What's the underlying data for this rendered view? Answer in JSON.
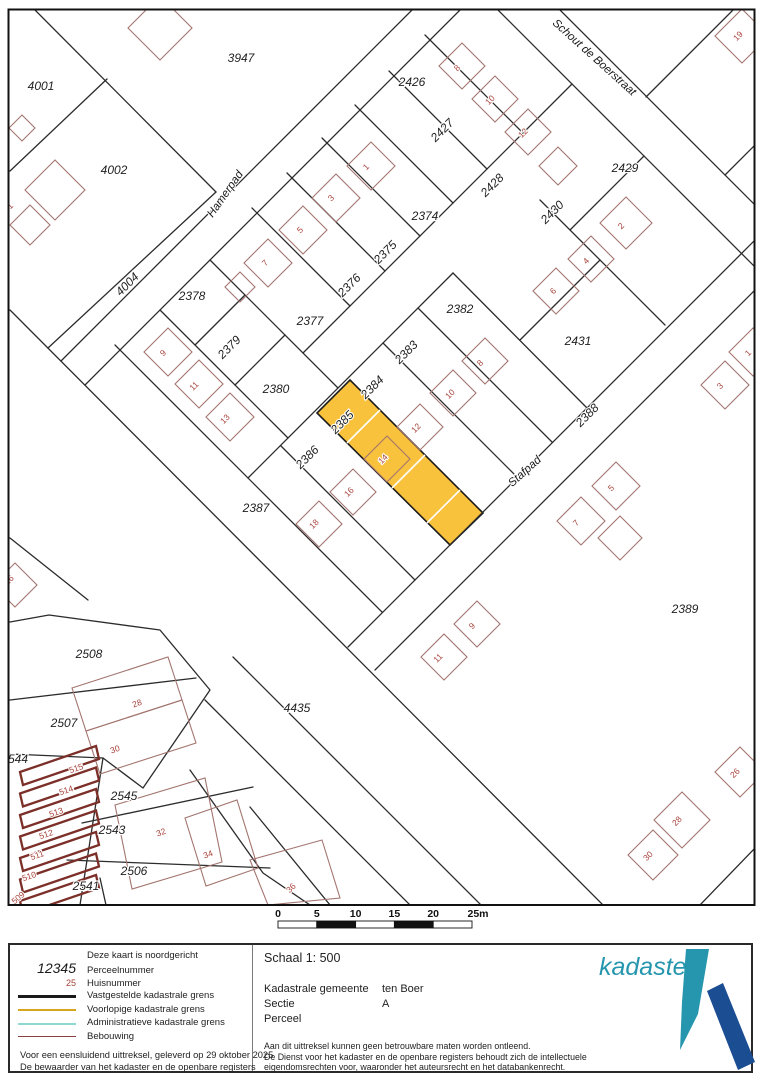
{
  "map": {
    "street_names": [
      {
        "t": "Hamerpad",
        "x": 228,
        "y": 196,
        "r": -55
      },
      {
        "t": "Schout de Boerstraat",
        "x": 592,
        "y": 60,
        "r": 42
      },
      {
        "t": "Stafpad",
        "x": 527,
        "y": 474,
        "r": -42
      }
    ],
    "parcel_labels": [
      {
        "t": "3947",
        "x": 241,
        "y": 62,
        "r": 0
      },
      {
        "t": "4001",
        "x": 41,
        "y": 90,
        "r": 0
      },
      {
        "t": "4002",
        "x": 114,
        "y": 174,
        "r": 0
      },
      {
        "t": "4004",
        "x": 130,
        "y": 287,
        "r": -45
      },
      {
        "t": "2426",
        "x": 412,
        "y": 86,
        "r": 0
      },
      {
        "t": "2427",
        "x": 445,
        "y": 133,
        "r": -45
      },
      {
        "t": "2428",
        "x": 495,
        "y": 188,
        "r": -45
      },
      {
        "t": "2429",
        "x": 625,
        "y": 172,
        "r": 0
      },
      {
        "t": "2430",
        "x": 555,
        "y": 215,
        "r": -45
      },
      {
        "t": "2431",
        "x": 578,
        "y": 345,
        "r": 0
      },
      {
        "t": "2374",
        "x": 425,
        "y": 220,
        "r": 0
      },
      {
        "t": "2375",
        "x": 388,
        "y": 255,
        "r": -45
      },
      {
        "t": "2376",
        "x": 352,
        "y": 288,
        "r": -45
      },
      {
        "t": "2377",
        "x": 310,
        "y": 325,
        "r": 0
      },
      {
        "t": "2378",
        "x": 192,
        "y": 300,
        "r": 0
      },
      {
        "t": "2379",
        "x": 232,
        "y": 350,
        "r": -45
      },
      {
        "t": "2380",
        "x": 276,
        "y": 393,
        "r": 0
      },
      {
        "t": "2382",
        "x": 460,
        "y": 313,
        "r": 0
      },
      {
        "t": "2383",
        "x": 409,
        "y": 355,
        "r": -45
      },
      {
        "t": "2384",
        "x": 375,
        "y": 390,
        "r": -45
      },
      {
        "t": "2385",
        "x": 345,
        "y": 425,
        "r": -45
      },
      {
        "t": "2386",
        "x": 310,
        "y": 460,
        "r": -45
      },
      {
        "t": "2387",
        "x": 256,
        "y": 512,
        "r": 0
      },
      {
        "t": "2388",
        "x": 590,
        "y": 418,
        "r": -45
      },
      {
        "t": "2389",
        "x": 685,
        "y": 613,
        "r": 0
      },
      {
        "t": "4435",
        "x": 297,
        "y": 712,
        "r": 0
      },
      {
        "t": "2508",
        "x": 89,
        "y": 658,
        "r": 0
      },
      {
        "t": "2507",
        "x": 64,
        "y": 727,
        "r": 0
      },
      {
        "t": "544",
        "x": 18,
        "y": 763,
        "r": 0
      },
      {
        "t": "2545",
        "x": 124,
        "y": 800,
        "r": 0
      },
      {
        "t": "2543",
        "x": 112,
        "y": 834,
        "r": 0
      },
      {
        "t": "2506",
        "x": 134,
        "y": 875,
        "r": 0
      },
      {
        "t": "2541",
        "x": 86,
        "y": 890,
        "r": 0
      }
    ],
    "house_numbers": [
      {
        "t": "19",
        "x": 740,
        "y": 38,
        "r": -45
      },
      {
        "t": "8",
        "x": 459,
        "y": 70,
        "r": -45
      },
      {
        "t": "10",
        "x": 492,
        "y": 102,
        "r": -45
      },
      {
        "t": "12",
        "x": 525,
        "y": 135,
        "r": -45
      },
      {
        "t": "1",
        "x": 368,
        "y": 169,
        "r": -45
      },
      {
        "t": "3",
        "x": 333,
        "y": 200,
        "r": -45
      },
      {
        "t": "5",
        "x": 302,
        "y": 232,
        "r": -45
      },
      {
        "t": "7",
        "x": 267,
        "y": 265,
        "r": -45
      },
      {
        "t": "2",
        "x": 623,
        "y": 228,
        "r": -45
      },
      {
        "t": "4",
        "x": 588,
        "y": 263,
        "r": -45
      },
      {
        "t": "6",
        "x": 555,
        "y": 293,
        "r": -45
      },
      {
        "t": "9",
        "x": 165,
        "y": 355,
        "r": -45
      },
      {
        "t": "11",
        "x": 196,
        "y": 388,
        "r": -45
      },
      {
        "t": "13",
        "x": 227,
        "y": 421,
        "r": -45
      },
      {
        "t": "8",
        "x": 482,
        "y": 365,
        "r": -45
      },
      {
        "t": "10",
        "x": 452,
        "y": 396,
        "r": -45
      },
      {
        "t": "12",
        "x": 418,
        "y": 430,
        "r": -45
      },
      {
        "t": "14",
        "x": 385,
        "y": 461,
        "r": -45
      },
      {
        "t": "16",
        "x": 351,
        "y": 494,
        "r": -45
      },
      {
        "t": "18",
        "x": 316,
        "y": 526,
        "r": -45
      },
      {
        "t": "5",
        "x": 613,
        "y": 490,
        "r": -45
      },
      {
        "t": "7",
        "x": 578,
        "y": 525,
        "r": -45
      },
      {
        "t": "9",
        "x": 474,
        "y": 628,
        "r": -45
      },
      {
        "t": "11",
        "x": 440,
        "y": 660,
        "r": -45
      },
      {
        "t": "1",
        "x": 750,
        "y": 355,
        "r": -45
      },
      {
        "t": "3",
        "x": 722,
        "y": 388,
        "r": -45
      },
      {
        "t": "26",
        "x": 737,
        "y": 775,
        "r": -45
      },
      {
        "t": "28",
        "x": 679,
        "y": 823,
        "r": -45
      },
      {
        "t": "30",
        "x": 650,
        "y": 858,
        "r": -45
      },
      {
        "t": "26",
        "x": 11,
        "y": 582,
        "r": -45
      },
      {
        "t": "28",
        "x": 138,
        "y": 706,
        "r": -20
      },
      {
        "t": "30",
        "x": 116,
        "y": 752,
        "r": -20
      },
      {
        "t": "32",
        "x": 162,
        "y": 835,
        "r": -20
      },
      {
        "t": "34",
        "x": 209,
        "y": 857,
        "r": -20
      },
      {
        "t": "36",
        "x": 293,
        "y": 890,
        "r": -45
      },
      {
        "t": "515",
        "x": 77,
        "y": 771,
        "r": -18
      },
      {
        "t": "514",
        "x": 67,
        "y": 793,
        "r": -18
      },
      {
        "t": "513",
        "x": 57,
        "y": 815,
        "r": -18
      },
      {
        "t": "512",
        "x": 47,
        "y": 837,
        "r": -18
      },
      {
        "t": "511",
        "x": 38,
        "y": 858,
        "r": -18
      },
      {
        "t": "510",
        "x": 30,
        "y": 879,
        "r": -18
      },
      {
        "t": "509",
        "x": 20,
        "y": 900,
        "r": -40
      },
      {
        "t": "1",
        "x": 12,
        "y": 208,
        "r": -45
      }
    ],
    "highlight": {
      "parcel": "2385",
      "fill": "#f9c23c"
    }
  },
  "scalebar": {
    "ticks": [
      "0",
      "5",
      "10",
      "15",
      "20",
      "25m"
    ]
  },
  "legend": {
    "rows": [
      {
        "label": "Deze kaart is noordgericht"
      },
      {
        "label": "Perceelnummer"
      },
      {
        "label": "Huisnummer"
      },
      {
        "label": "Vastgestelde kadastrale grens"
      },
      {
        "label": "Voorlopige kadastrale grens"
      },
      {
        "label": "Administratieve kadastrale grens"
      },
      {
        "label": "Bebouwing"
      }
    ],
    "sample_parcel": "12345",
    "sample_house": "25",
    "footer1": "Voor een eensluidend uittreksel, geleverd op 29 oktober 2025",
    "footer2": "De bewaarder van het kadaster en de openbare registers"
  },
  "info": {
    "schaal": "Schaal 1: 500",
    "gemeente_label": "Kadastrale gemeente",
    "gemeente_value": "ten Boer",
    "sectie_label": "Sectie",
    "sectie_value": "A",
    "perceel_label": "Perceel",
    "perceel_value": "2385",
    "fine1": "Aan dit uittreksel kunnen geen betrouwbare maten worden ontleend.",
    "fine2": "De Dienst voor het kadaster en de openbare registers behoudt zich de intellectuele",
    "fine3": "eigendomsrechten voor, waaronder het auteursrecht en het databankenrecht."
  },
  "logo": {
    "brand": "kadaster",
    "teal": "#2596ae",
    "blue": "#1b4d92"
  }
}
